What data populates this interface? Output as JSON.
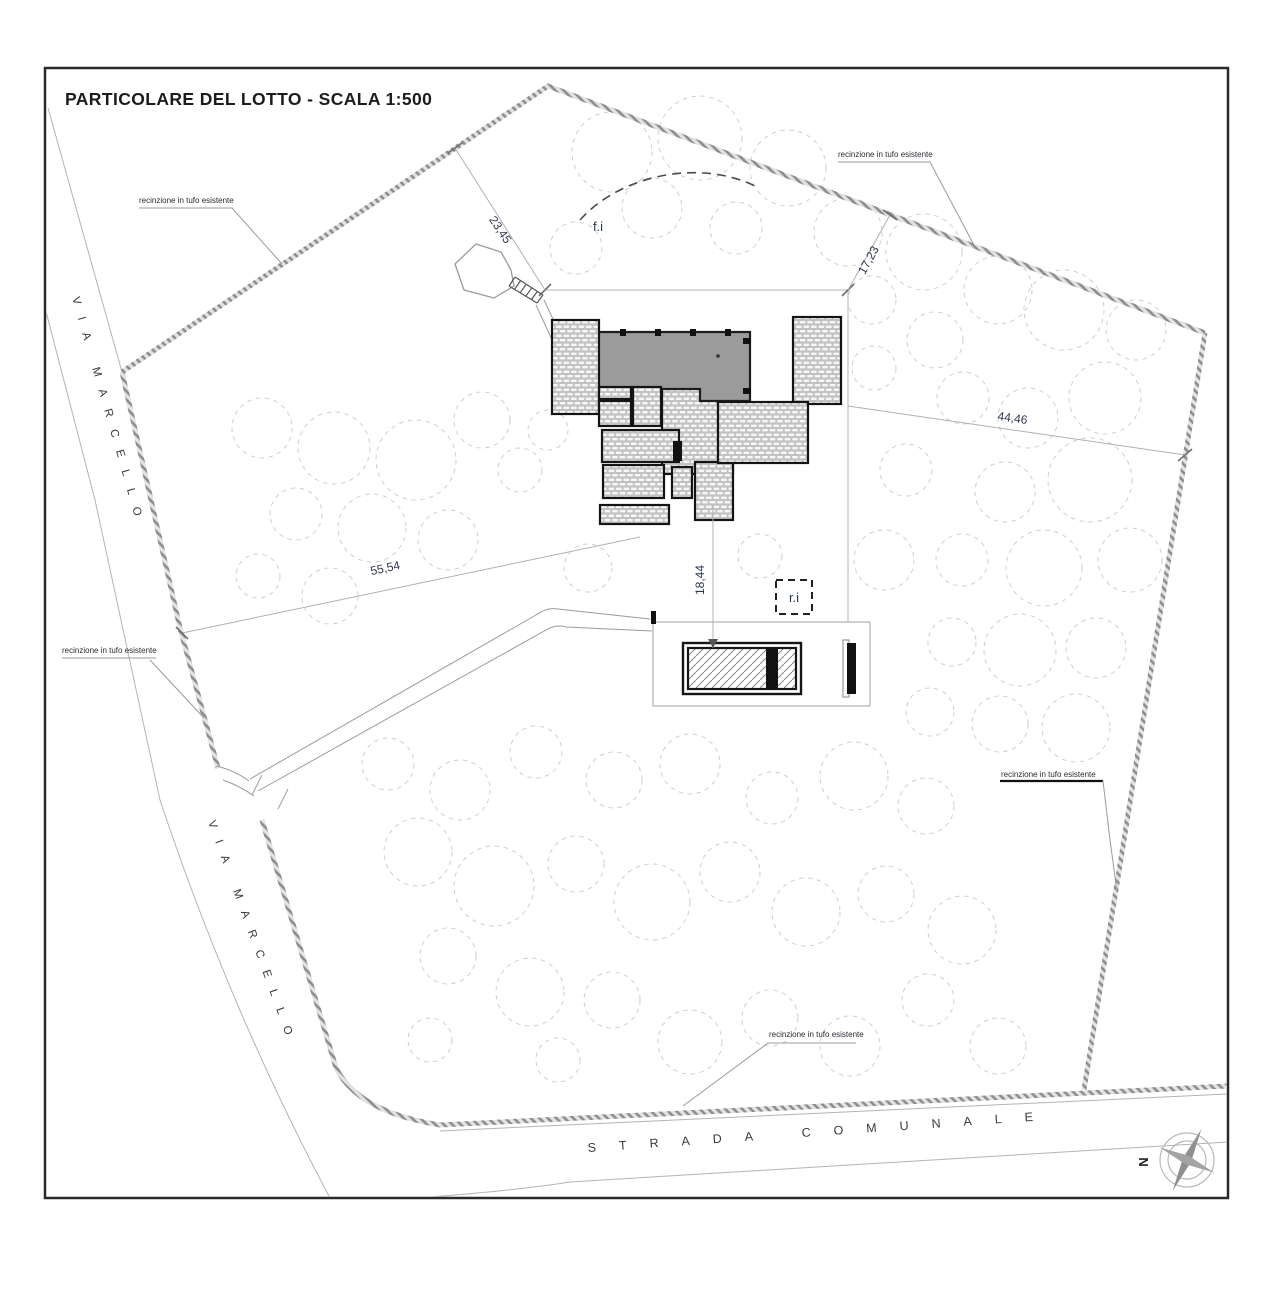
{
  "title": "PARTICOLARE DEL LOTTO - SCALA 1:500",
  "streets": {
    "via_marcello": "VIA MARCELLO",
    "strada_comunale": "STRADA COMUNALE"
  },
  "annotations": {
    "fence_label": "recinzione in tufo esistente",
    "fi_label": "f.i",
    "ri_label": "r.i",
    "north_label": "N"
  },
  "dimensions": {
    "nw_side": "23,45",
    "ne_side": "17,23",
    "east_side": "44,46",
    "sw_side": "55,54",
    "pool_distance": "18,44"
  },
  "colors": {
    "roof_gray": "#9b9b9b",
    "boundary_gray": "#8d8d8d",
    "line_dark": "#1a1a1a"
  },
  "site": {
    "trees": [
      [
        612,
        152,
        40
      ],
      [
        700,
        138,
        42
      ],
      [
        788,
        168,
        38
      ],
      [
        652,
        208,
        30
      ],
      [
        576,
        248,
        26
      ],
      [
        736,
        228,
        26
      ],
      [
        848,
        232,
        34
      ],
      [
        924,
        252,
        38
      ],
      [
        998,
        290,
        34
      ],
      [
        1064,
        310,
        40
      ],
      [
        1136,
        330,
        30
      ],
      [
        872,
        300,
        24
      ],
      [
        935,
        340,
        28
      ],
      [
        1105,
        398,
        36
      ],
      [
        1028,
        418,
        30
      ],
      [
        963,
        398,
        26
      ],
      [
        1090,
        480,
        42
      ],
      [
        1005,
        492,
        30
      ],
      [
        1130,
        560,
        32
      ],
      [
        1044,
        568,
        38
      ],
      [
        962,
        560,
        26
      ],
      [
        1096,
        648,
        30
      ],
      [
        1020,
        650,
        36
      ],
      [
        952,
        642,
        24
      ],
      [
        1076,
        728,
        34
      ],
      [
        1000,
        724,
        28
      ],
      [
        930,
        712,
        24
      ],
      [
        262,
        428,
        30
      ],
      [
        334,
        448,
        36
      ],
      [
        416,
        460,
        40
      ],
      [
        482,
        420,
        28
      ],
      [
        296,
        514,
        26
      ],
      [
        372,
        528,
        34
      ],
      [
        448,
        540,
        30
      ],
      [
        258,
        576,
        22
      ],
      [
        330,
        596,
        28
      ],
      [
        520,
        470,
        22
      ],
      [
        548,
        430,
        20
      ],
      [
        588,
        568,
        24
      ],
      [
        760,
        556,
        22
      ],
      [
        884,
        560,
        30
      ],
      [
        906,
        470,
        26
      ],
      [
        874,
        368,
        22
      ],
      [
        388,
        764,
        26
      ],
      [
        460,
        790,
        30
      ],
      [
        536,
        752,
        26
      ],
      [
        614,
        780,
        28
      ],
      [
        690,
        764,
        30
      ],
      [
        772,
        798,
        26
      ],
      [
        854,
        776,
        34
      ],
      [
        926,
        806,
        28
      ],
      [
        418,
        852,
        34
      ],
      [
        494,
        886,
        40
      ],
      [
        576,
        864,
        28
      ],
      [
        652,
        902,
        38
      ],
      [
        730,
        872,
        30
      ],
      [
        806,
        912,
        34
      ],
      [
        886,
        894,
        28
      ],
      [
        962,
        930,
        34
      ],
      [
        448,
        956,
        28
      ],
      [
        530,
        992,
        34
      ],
      [
        612,
        1000,
        28
      ],
      [
        690,
        1042,
        32
      ],
      [
        770,
        1018,
        28
      ],
      [
        850,
        1046,
        30
      ],
      [
        928,
        1000,
        26
      ],
      [
        998,
        1046,
        28
      ],
      [
        558,
        1060,
        22
      ],
      [
        430,
        1040,
        22
      ]
    ]
  }
}
